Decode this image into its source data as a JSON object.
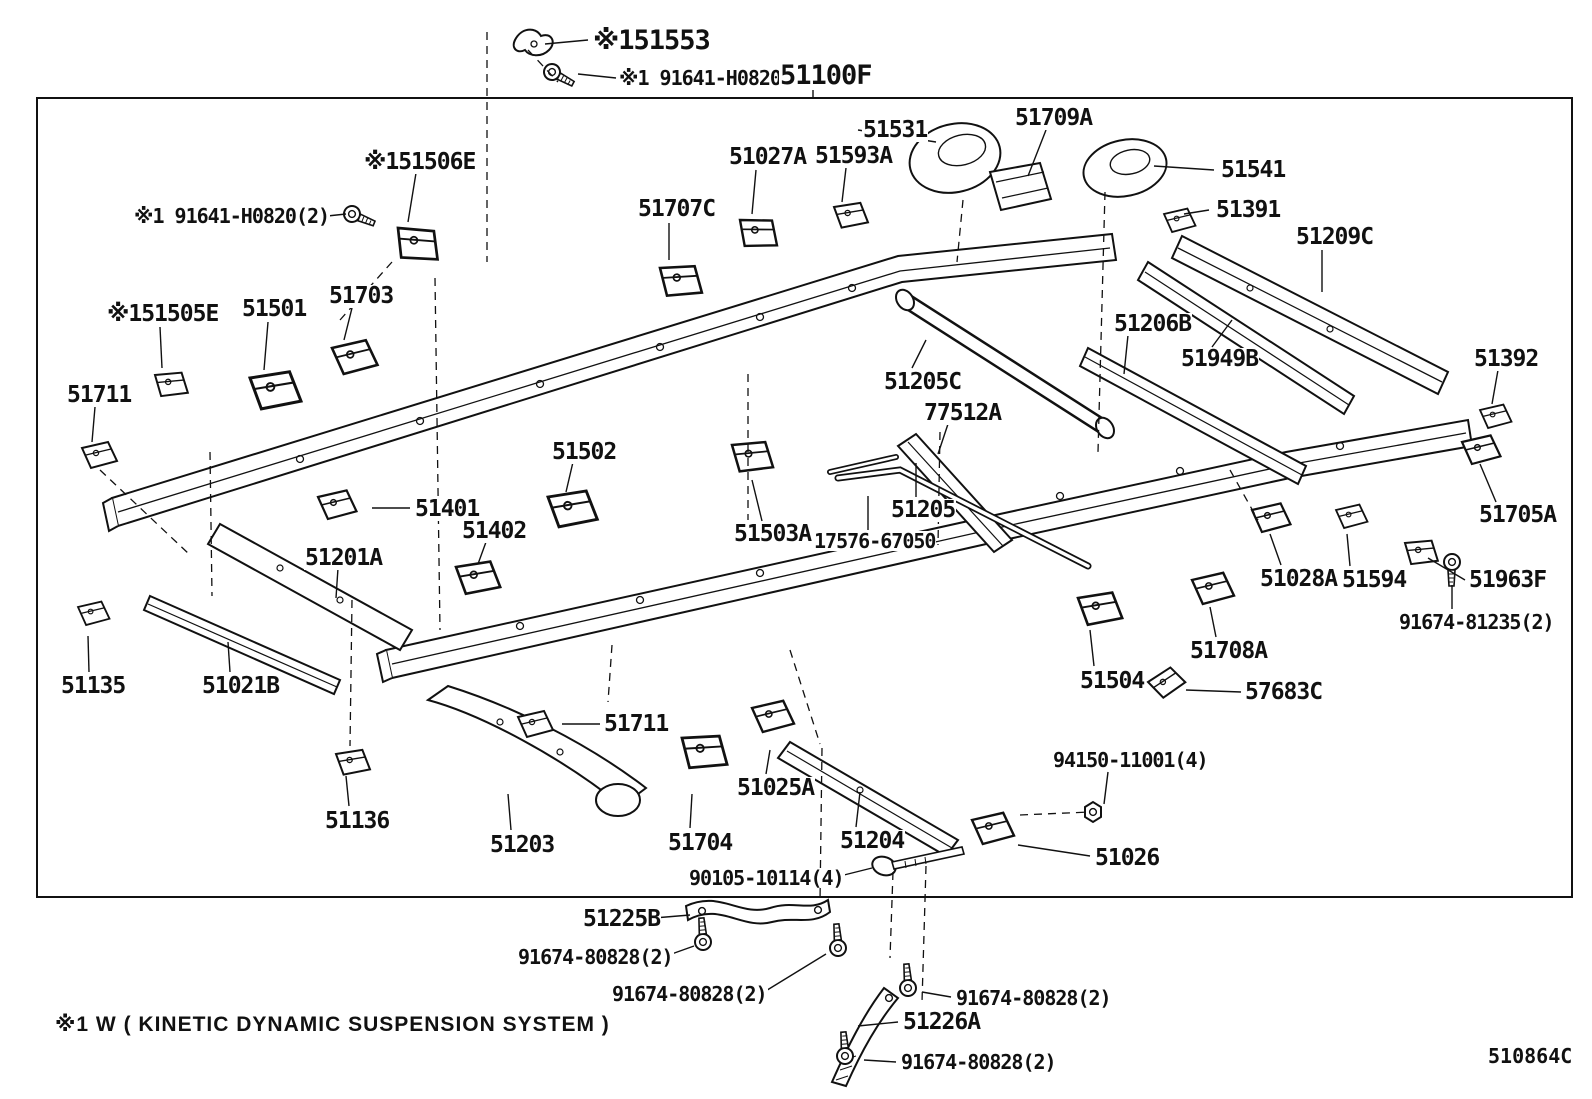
{
  "diagram": {
    "note": "※1 W ( KINETIC DYNAMIC SUSPENSION SYSTEM )",
    "code": "510864C",
    "line_color": "#111111",
    "background": "#ffffff",
    "labels": [
      {
        "t": "※151553",
        "x": 592,
        "y": 27,
        "s": "xl"
      },
      {
        "t": "※1 91641-H0820",
        "x": 618,
        "y": 68,
        "s": "md"
      },
      {
        "t": "51100F",
        "x": 779,
        "y": 62,
        "s": "xl"
      },
      {
        "t": "51531",
        "x": 862,
        "y": 119,
        "s": "lg"
      },
      {
        "t": "51709A",
        "x": 1014,
        "y": 107,
        "s": "lg"
      },
      {
        "t": "51027A",
        "x": 728,
        "y": 146,
        "s": "lg"
      },
      {
        "t": "51593A",
        "x": 814,
        "y": 145,
        "s": "lg"
      },
      {
        "t": "51707C",
        "x": 637,
        "y": 198,
        "s": "lg"
      },
      {
        "t": "51541",
        "x": 1220,
        "y": 159,
        "s": "lg"
      },
      {
        "t": "51391",
        "x": 1215,
        "y": 199,
        "s": "lg"
      },
      {
        "t": "51209C",
        "x": 1295,
        "y": 226,
        "s": "lg"
      },
      {
        "t": "※151506E",
        "x": 363,
        "y": 151,
        "s": "lg"
      },
      {
        "t": "※1 91641-H0820(2)",
        "x": 133,
        "y": 206,
        "s": "md"
      },
      {
        "t": "※151505E",
        "x": 106,
        "y": 303,
        "s": "lg"
      },
      {
        "t": "51501",
        "x": 241,
        "y": 298,
        "s": "lg"
      },
      {
        "t": "51703",
        "x": 328,
        "y": 285,
        "s": "lg"
      },
      {
        "t": "51711",
        "x": 66,
        "y": 384,
        "s": "lg"
      },
      {
        "t": "51206B",
        "x": 1113,
        "y": 313,
        "s": "lg"
      },
      {
        "t": "51949B",
        "x": 1180,
        "y": 348,
        "s": "lg"
      },
      {
        "t": "51205C",
        "x": 883,
        "y": 371,
        "s": "lg"
      },
      {
        "t": "77512A",
        "x": 923,
        "y": 402,
        "s": "lg"
      },
      {
        "t": "51502",
        "x": 551,
        "y": 441,
        "s": "lg"
      },
      {
        "t": "51503A",
        "x": 733,
        "y": 523,
        "s": "lg"
      },
      {
        "t": "17576-67050",
        "x": 813,
        "y": 531,
        "s": "md"
      },
      {
        "t": "51205",
        "x": 890,
        "y": 499,
        "s": "lg"
      },
      {
        "t": "51392",
        "x": 1473,
        "y": 348,
        "s": "lg"
      },
      {
        "t": "51705A",
        "x": 1478,
        "y": 504,
        "s": "lg"
      },
      {
        "t": "51963F",
        "x": 1468,
        "y": 569,
        "s": "lg"
      },
      {
        "t": "91674-81235(2)",
        "x": 1398,
        "y": 612,
        "s": "md"
      },
      {
        "t": "51028A",
        "x": 1259,
        "y": 568,
        "s": "lg"
      },
      {
        "t": "51594",
        "x": 1341,
        "y": 569,
        "s": "lg"
      },
      {
        "t": "51401",
        "x": 414,
        "y": 498,
        "s": "lg"
      },
      {
        "t": "51402",
        "x": 461,
        "y": 520,
        "s": "lg"
      },
      {
        "t": "51201A",
        "x": 304,
        "y": 547,
        "s": "lg"
      },
      {
        "t": "51135",
        "x": 60,
        "y": 675,
        "s": "lg"
      },
      {
        "t": "51021B",
        "x": 201,
        "y": 675,
        "s": "lg"
      },
      {
        "t": "51136",
        "x": 324,
        "y": 810,
        "s": "lg"
      },
      {
        "t": "51504",
        "x": 1079,
        "y": 670,
        "s": "lg"
      },
      {
        "t": "51708A",
        "x": 1189,
        "y": 640,
        "s": "lg"
      },
      {
        "t": "57683C",
        "x": 1244,
        "y": 681,
        "s": "lg"
      },
      {
        "t": "51711",
        "x": 603,
        "y": 713,
        "s": "lg"
      },
      {
        "t": "51203",
        "x": 489,
        "y": 834,
        "s": "lg"
      },
      {
        "t": "51704",
        "x": 667,
        "y": 832,
        "s": "lg"
      },
      {
        "t": "51025A",
        "x": 736,
        "y": 777,
        "s": "lg"
      },
      {
        "t": "51204",
        "x": 839,
        "y": 830,
        "s": "lg"
      },
      {
        "t": "94150-11001(4)",
        "x": 1052,
        "y": 750,
        "s": "md"
      },
      {
        "t": "51026",
        "x": 1094,
        "y": 847,
        "s": "lg"
      },
      {
        "t": "90105-10114(4)",
        "x": 688,
        "y": 868,
        "s": "md"
      },
      {
        "t": "51225B",
        "x": 582,
        "y": 908,
        "s": "lg"
      },
      {
        "t": "91674-80828(2)",
        "x": 517,
        "y": 947,
        "s": "md"
      },
      {
        "t": "91674-80828(2)",
        "x": 611,
        "y": 984,
        "s": "md"
      },
      {
        "t": "91674-80828(2)",
        "x": 955,
        "y": 988,
        "s": "md"
      },
      {
        "t": "51226A",
        "x": 902,
        "y": 1011,
        "s": "lg"
      },
      {
        "t": "91674-80828(2)",
        "x": 900,
        "y": 1052,
        "s": "md"
      }
    ]
  }
}
